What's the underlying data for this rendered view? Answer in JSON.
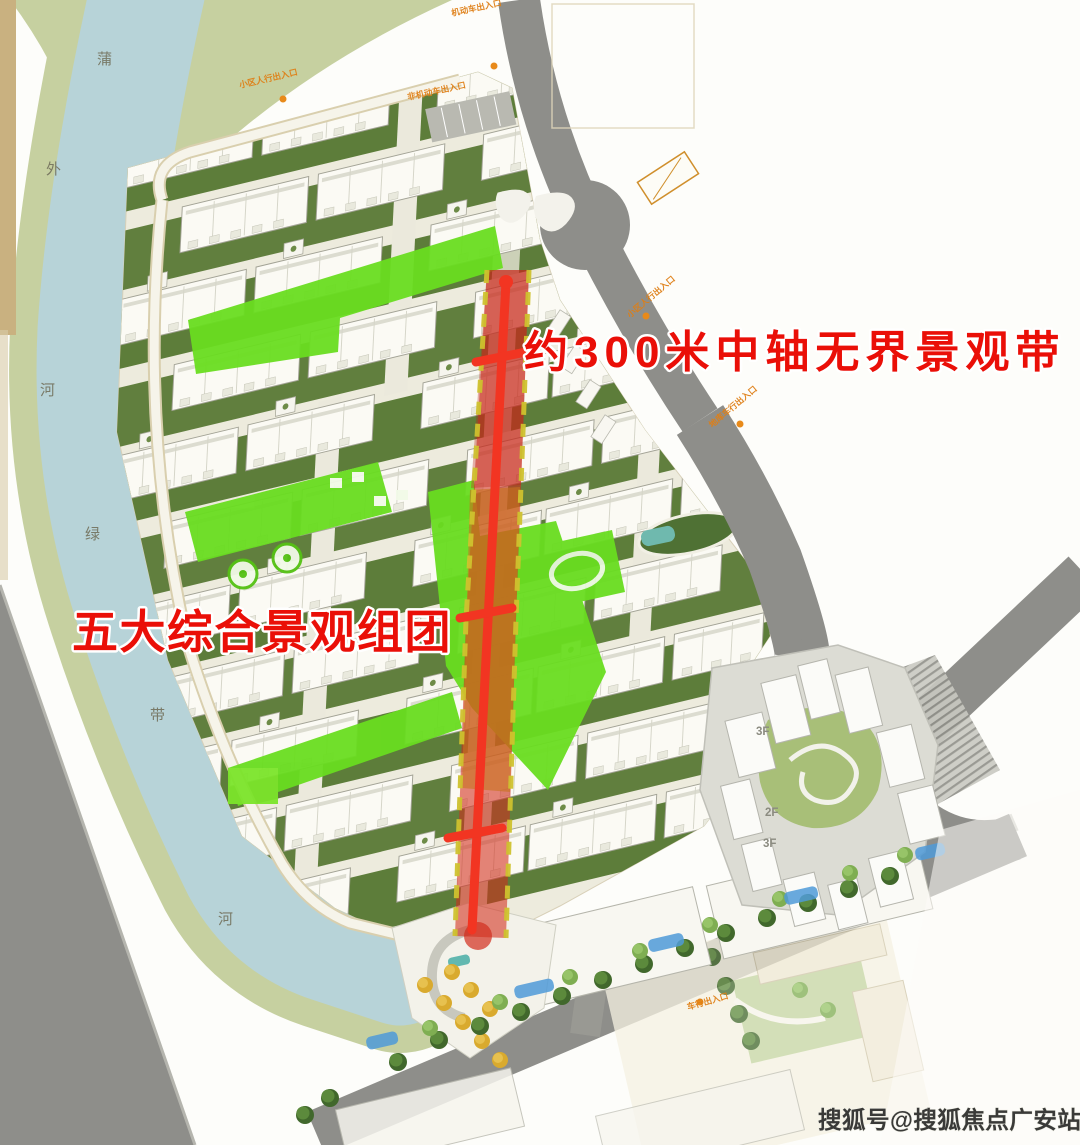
{
  "annotations": {
    "axis": "约300米中轴无界景观带",
    "clusters": "五大综合景观组团"
  },
  "watermark": "搜狐号@搜狐焦点广安站",
  "river": {
    "chars": [
      "蒲",
      "外",
      "河",
      "绿",
      "带",
      "河"
    ]
  },
  "commercial": {
    "floors": [
      "3F",
      "2F",
      "3F"
    ]
  },
  "entrances": [
    {
      "text": "机动车出入口"
    },
    {
      "text": "小区人行出入口"
    },
    {
      "text": "小区人行出入口"
    },
    {
      "text": "地库车行出入口"
    },
    {
      "text": "车行出入口"
    },
    {
      "text": "非机动车出入口"
    }
  ],
  "colors": {
    "water": "#b7d3d8",
    "river_bank": "#c6d0a0",
    "courtyard_green": "#5d7d3a",
    "highlight_green": "#69dd20",
    "axis_red": "#e8341c",
    "axis_orange": "#d97c1e",
    "axis_dash_yellow": "#cfc22e",
    "road_gray": "#8e8e8a",
    "building_white": "#fbfaf4",
    "annotation_red": "#ea0f08",
    "entrance_orange": "#df7f16"
  }
}
